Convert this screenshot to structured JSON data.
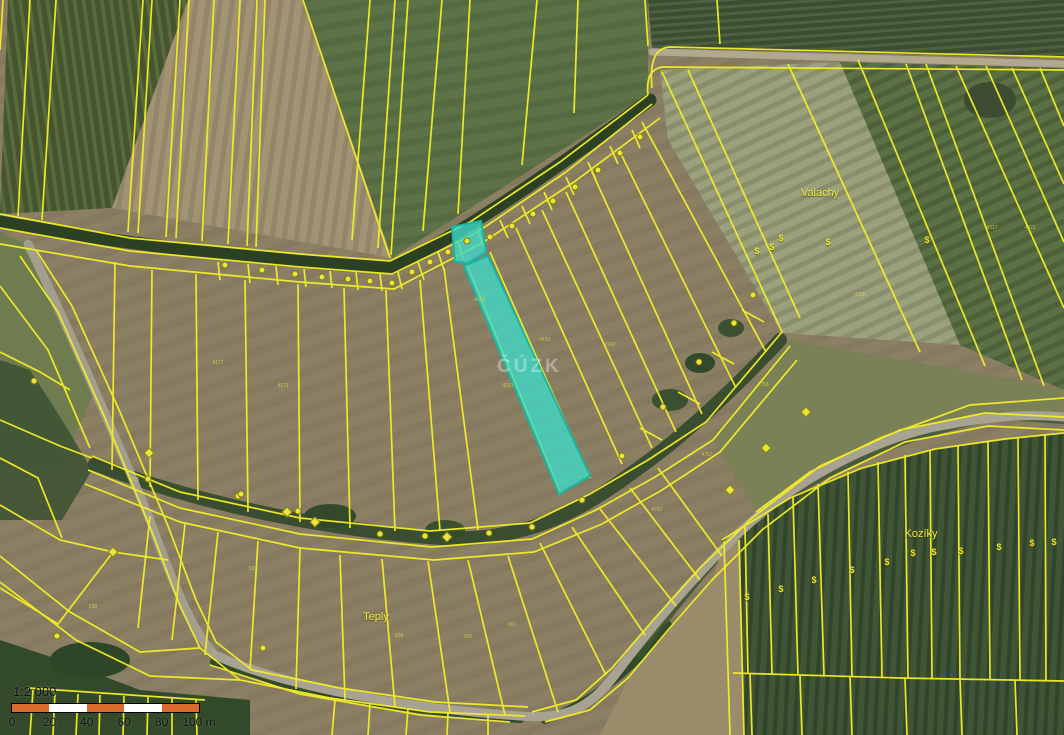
{
  "map": {
    "type": "cadastral-aerial-map",
    "watermark": "ČÚZK",
    "boundary_color": "#f4ef25",
    "highlight_color": "#3fd8c7",
    "place_labels": [
      {
        "text": "Valachy",
        "x": 820,
        "y": 193
      },
      {
        "text": "Kozíky",
        "x": 921,
        "y": 534
      },
      {
        "text": "Teplý",
        "x": 376,
        "y": 617
      }
    ],
    "parcel_numbers": [
      {
        "text": "638",
        "x": 93,
        "y": 607
      },
      {
        "text": "631",
        "x": 253,
        "y": 569
      },
      {
        "text": "615",
        "x": 135,
        "y": 480
      },
      {
        "text": "608",
        "x": 399,
        "y": 636
      },
      {
        "text": "605",
        "x": 468,
        "y": 637
      },
      {
        "text": "601",
        "x": 512,
        "y": 625
      },
      {
        "text": "4171",
        "x": 283,
        "y": 386
      },
      {
        "text": "4177",
        "x": 218,
        "y": 363
      },
      {
        "text": "4161",
        "x": 508,
        "y": 386
      },
      {
        "text": "4158",
        "x": 480,
        "y": 300
      },
      {
        "text": "4153",
        "x": 545,
        "y": 340
      },
      {
        "text": "2747",
        "x": 610,
        "y": 345
      },
      {
        "text": "2753",
        "x": 763,
        "y": 385
      },
      {
        "text": "4787",
        "x": 657,
        "y": 510
      },
      {
        "text": "4757",
        "x": 707,
        "y": 455
      },
      {
        "text": "4305",
        "x": 860,
        "y": 295
      },
      {
        "text": "4317",
        "x": 992,
        "y": 228
      },
      {
        "text": "4321",
        "x": 1030,
        "y": 228
      }
    ],
    "symbols": {
      "vineyard_glyph": "$",
      "dollars": [
        [
          757,
          251
        ],
        [
          772,
          247
        ],
        [
          781,
          238
        ],
        [
          828,
          242
        ],
        [
          927,
          240
        ],
        [
          747,
          597
        ],
        [
          781,
          589
        ],
        [
          814,
          580
        ],
        [
          852,
          570
        ],
        [
          887,
          562
        ],
        [
          913,
          553
        ],
        [
          934,
          552
        ],
        [
          961,
          551
        ],
        [
          999,
          547
        ],
        [
          1032,
          543
        ],
        [
          1054,
          542
        ]
      ],
      "dots": [
        [
          225,
          265
        ],
        [
          262,
          270
        ],
        [
          295,
          274
        ],
        [
          322,
          277
        ],
        [
          348,
          279
        ],
        [
          370,
          281
        ],
        [
          392,
          283
        ],
        [
          412,
          272
        ],
        [
          430,
          262
        ],
        [
          448,
          252
        ],
        [
          467,
          241
        ],
        [
          490,
          237
        ],
        [
          512,
          226
        ],
        [
          533,
          214
        ],
        [
          553,
          201
        ],
        [
          575,
          187
        ],
        [
          598,
          170
        ],
        [
          620,
          153
        ],
        [
          640,
          137
        ],
        [
          148,
          479
        ],
        [
          238,
          496
        ],
        [
          298,
          511
        ],
        [
          380,
          534
        ],
        [
          425,
          536
        ],
        [
          489,
          533
        ],
        [
          532,
          527
        ],
        [
          582,
          500
        ],
        [
          622,
          456
        ],
        [
          663,
          407
        ],
        [
          699,
          362
        ],
        [
          734,
          323
        ],
        [
          753,
          295
        ],
        [
          34,
          381
        ],
        [
          241,
          494
        ],
        [
          263,
          648
        ],
        [
          57,
          636
        ]
      ],
      "diamonds": [
        [
          113,
          552
        ],
        [
          287,
          512
        ],
        [
          315,
          522
        ],
        [
          447,
          537
        ],
        [
          766,
          448
        ],
        [
          806,
          412
        ],
        [
          730,
          490
        ],
        [
          149,
          453
        ]
      ]
    }
  },
  "scale_bar": {
    "ratio_label": "1:2 000",
    "tick_labels": [
      "0",
      "20",
      "40",
      "60",
      "80",
      "100 m"
    ],
    "segment_colors": [
      "#d96a2e",
      "#ffffff",
      "#d96a2e",
      "#ffffff",
      "#d96a2e"
    ]
  }
}
